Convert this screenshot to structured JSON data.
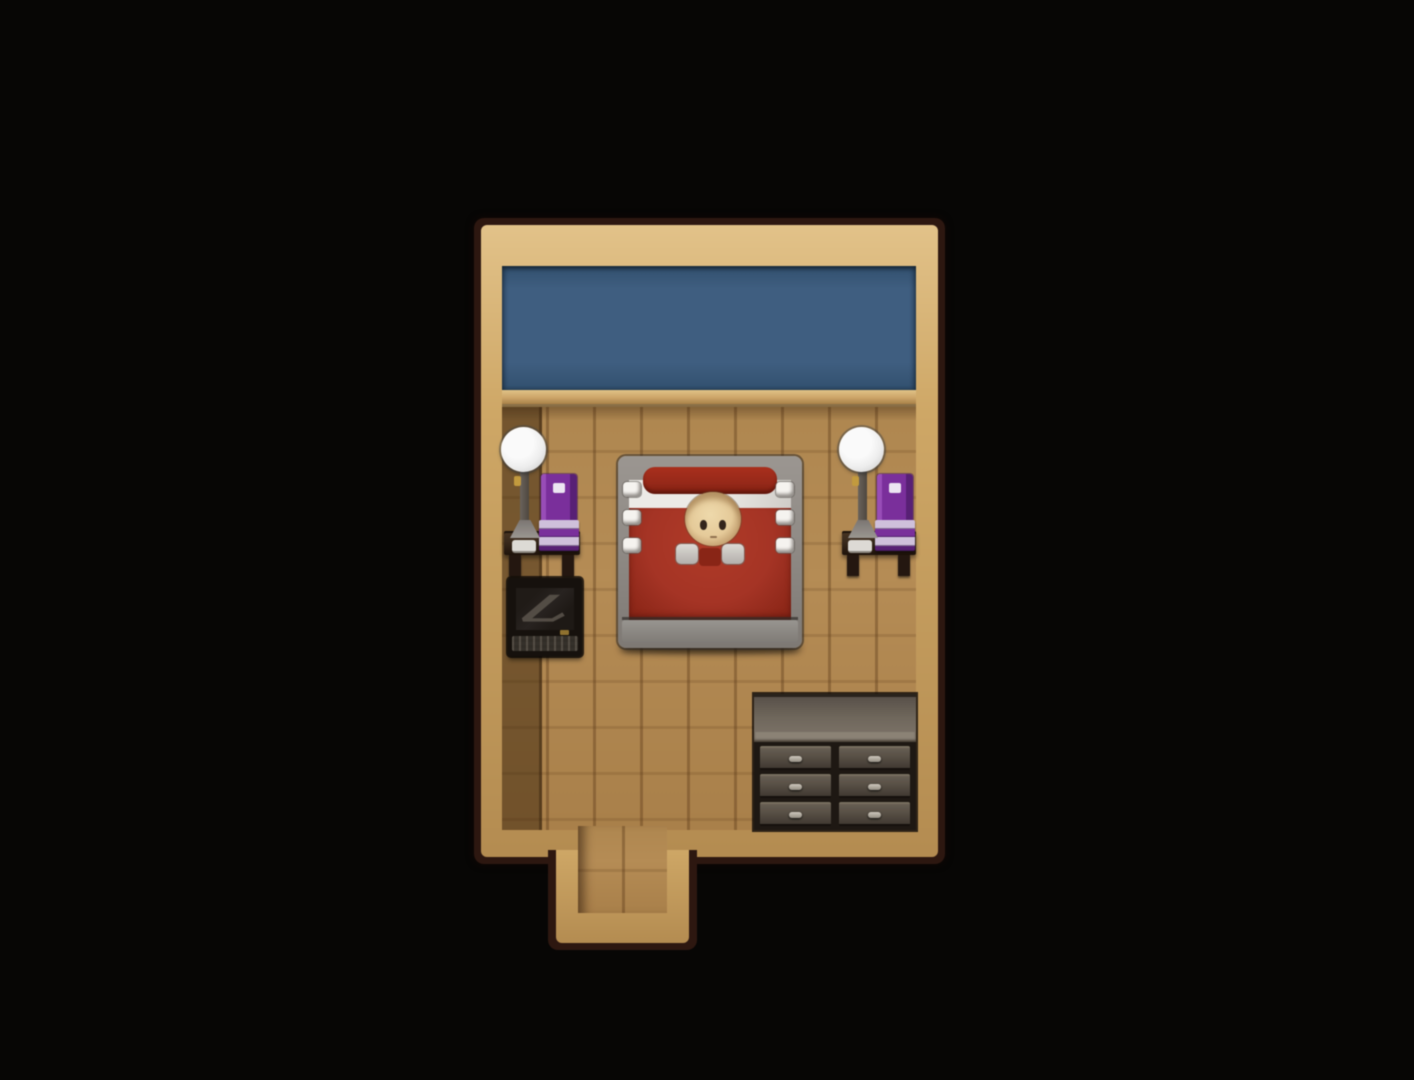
{
  "meta": {
    "app": "retro RPG game screenshot",
    "view": "top-down interior map of a small bedroom on a black void background",
    "visible_text": "none"
  },
  "scene": {
    "room": {
      "name": "bedroom",
      "wall": "plain blue wallpaper band along the top",
      "floor": "light wooden plank floor",
      "frame": "tan wooden wall-top border with dark outer edge",
      "exit": "short corridor opening protruding from the bottom wall, left of center"
    },
    "entities": [
      {
        "name": "bed",
        "desc": "double bed, gray frame, red blanket, white sheet, dark-red bolster, three white knobs per side rail"
      },
      {
        "name": "sleeping-character",
        "desc": "bald light-skinned character asleep in the bed, head on pillow, white collar pieces at shoulders"
      },
      {
        "name": "nightstand-left",
        "desc": "dark wooden wall table holding a white globe lamp, stack of purple books and a small white cup"
      },
      {
        "name": "nightstand-right",
        "desc": "mirror copy of the left nightstand with lamp and purple books"
      },
      {
        "name": "computer-desk",
        "desc": "black desk with dark monitor showing a zigzag reflection and a keyboard"
      },
      {
        "name": "dresser",
        "desc": "six-drawer dresser (2 columns x 3 rows) with gray wooden top, bottom-right corner"
      },
      {
        "name": "doorway",
        "desc": "walkable corridor exit at the bottom of the room"
      }
    ]
  },
  "furniture": {
    "bed": {
      "knobs_per_side": 3
    },
    "dresser": {
      "columns": 2,
      "rows": 3
    },
    "books": {
      "stripes": [
        {
          "color": "lavender",
          "h": 9
        },
        {
          "color": "purple",
          "h": 8
        },
        {
          "color": "lavender",
          "h": 9
        },
        {
          "color": "purple_dark",
          "h": 5
        }
      ]
    }
  },
  "colors": {
    "bg_black": "#070605",
    "frame_dark": "#2e1710",
    "frame_tan": "#cfa763",
    "frame_tan_light": "#e3c286",
    "frame_tan_dark": "#b58c4e",
    "wall_blue": "#3e5e82",
    "wall_blue_dark": "#31506f",
    "baseboard": "#cda566",
    "floor_wood": "#b68c53",
    "shadow_column": "rgba(58,36,10,0.5)",
    "bed_frame": "#908b86",
    "bed_red": "#a93323",
    "bed_red_deep": "#8c2415",
    "bolster": "#9a2817",
    "sheet": "#eceae6",
    "knob": "#f5f3ef",
    "skin": "#e6ca97",
    "skin_edge": "#ab8050",
    "eye": "#35251a",
    "collar": "#dddad5",
    "lamp_white": "#fafafa",
    "lamp_shade_gray": "#c2c2c2",
    "metal": "#4e473f",
    "gold": "#c49a3a",
    "wood_table": "#3a2a1b",
    "wood_table_dark": "#1f130b",
    "purple": "#7c2e9f",
    "purple_dark": "#5a1f78",
    "lavender": "#cfc0dc",
    "label": "#ece5f2",
    "computer_body": "#16110d",
    "screen": "#282320",
    "glare": "#5c554c",
    "keys": "#322d27",
    "dresser_top": "#6f675b",
    "dresser_top_light": "#8b8274",
    "dresser_body": "#1e1813",
    "drawer": "#574f45",
    "drawer_light": "#786f5e",
    "drawer_dark": "#15100c",
    "handle": "#cdc7bc"
  }
}
